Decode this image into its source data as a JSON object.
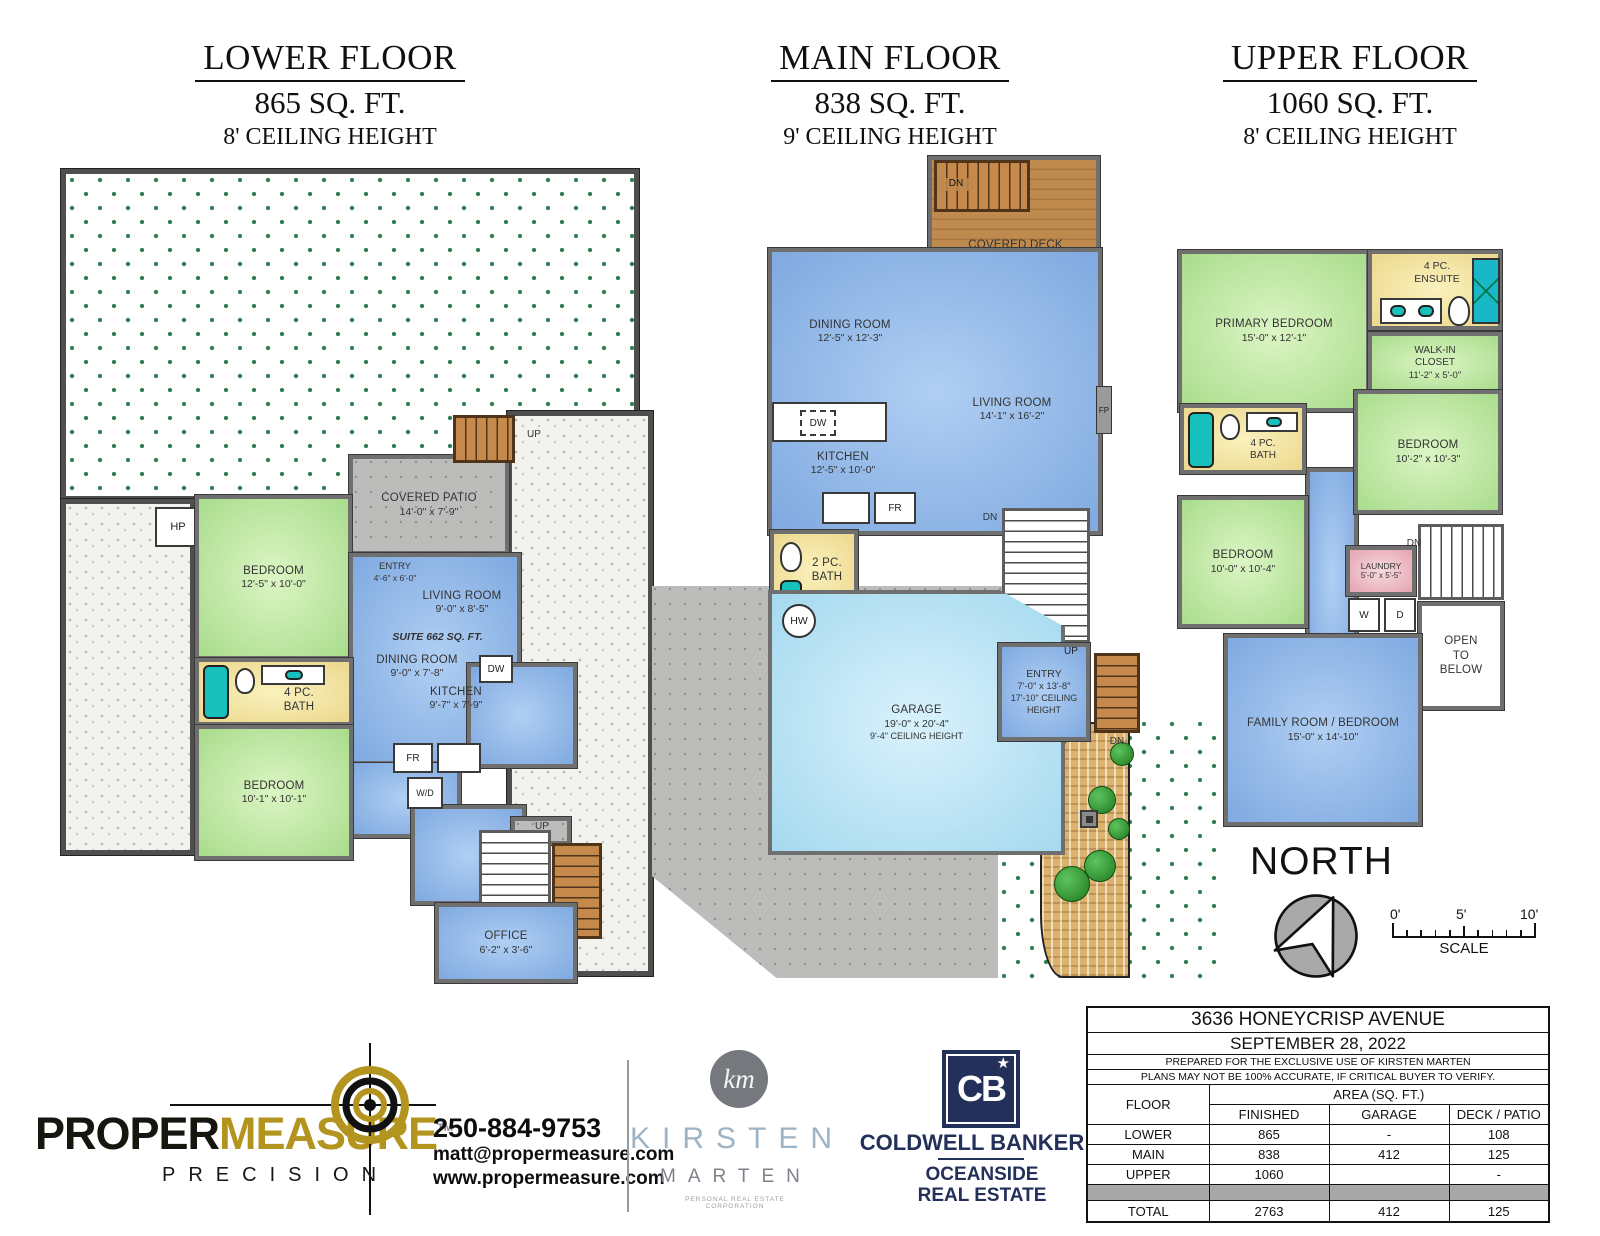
{
  "titles": {
    "lower": {
      "floor": "LOWER FLOOR",
      "area": "865 SQ. FT.",
      "ceiling": "8' CEILING HEIGHT"
    },
    "main": {
      "floor": "MAIN FLOOR",
      "area": "838 SQ. FT.",
      "ceiling": "9' CEILING HEIGHT"
    },
    "upper": {
      "floor": "UPPER FLOOR",
      "area": "1060 SQ. FT.",
      "ceiling": "8' CEILING HEIGHT"
    }
  },
  "lower": {
    "hp": "HP",
    "bedroom1": {
      "name": "BEDROOM",
      "dims": "12'-5\" x 10'-0\""
    },
    "patio": {
      "name": "COVERED PATIO",
      "dims": "14'-0\" x 7'-9\""
    },
    "up_top": "UP",
    "entry": {
      "name": "ENTRY",
      "dims": "4'-6\" x 6'-0\""
    },
    "living": {
      "name": "LIVING ROOM",
      "dims": "9'-0\" x 8'-5\""
    },
    "suite": "SUITE 662 SQ. FT.",
    "dining": {
      "name": "DINING ROOM",
      "dims": "9'-0\" x 7'-8\""
    },
    "kitchen": {
      "name": "KITCHEN",
      "dims": "9'-7\" x 7'-9\""
    },
    "dw": "DW",
    "fr": "FR",
    "wd": "W/D",
    "bath": {
      "name": "4 PC.",
      "name2": "BATH"
    },
    "bedroom2": {
      "name": "BEDROOM",
      "dims": "10'-1\" x 10'-1\""
    },
    "up_mid": "UP",
    "up_stairs": "UP",
    "office": {
      "name": "OFFICE",
      "dims": "6'-2\" x 3'-6\""
    }
  },
  "main": {
    "deck": {
      "name": "COVERED DECK",
      "dims": "14'-1\" x 7'-10\""
    },
    "dn_deck": "DN",
    "dining": {
      "name": "DINING ROOM",
      "dims": "12'-5\" x 12'-3\""
    },
    "living": {
      "name": "LIVING ROOM",
      "dims": "14'-1\" x 16'-2\""
    },
    "fp": "FP",
    "dw": "DW",
    "kitchen": {
      "name": "KITCHEN",
      "dims": "12'-5\" x 10'-0\""
    },
    "fr": "FR",
    "bath": {
      "name": "2 PC.",
      "name2": "BATH"
    },
    "hw": "HW",
    "dn_stairs": "DN",
    "entry": {
      "name": "ENTRY",
      "dims": "7'-0\" x 13'-8\"",
      "ceiling": "17'-10\" CEILING HEIGHT"
    },
    "up": "UP",
    "dn_out": "DN",
    "garage": {
      "name": "GARAGE",
      "dims": "19'-0\" x 20'-4\"",
      "ceiling": "9'-4\" CEILING HEIGHT"
    }
  },
  "upper": {
    "primary": {
      "name": "PRIMARY BEDROOM",
      "dims": "15'-0\" x 12'-1\""
    },
    "ensuite": {
      "name": "4 PC.",
      "name2": "ENSUITE"
    },
    "wic": {
      "name": "WALK-IN",
      "name2": "CLOSET",
      "dims": "11'-2\" x 5'-0\""
    },
    "bath": {
      "name": "4 PC.",
      "name2": "BATH"
    },
    "bedroom1": {
      "name": "BEDROOM",
      "dims": "10'-2\" x 10'-3\""
    },
    "bedroom2": {
      "name": "BEDROOM",
      "dims": "10'-0\" x 10'-4\""
    },
    "laundry": {
      "name": "LAUNDRY",
      "dims": "5'-0\" x 5'-5\""
    },
    "w": "W",
    "d": "D",
    "dn": "DN",
    "open": {
      "l1": "OPEN",
      "l2": "TO",
      "l3": "BELOW"
    },
    "family": {
      "name": "FAMILY ROOM / BEDROOM",
      "dims": "15'-0\" x 14'-10\""
    }
  },
  "compass": {
    "north": "NORTH"
  },
  "scalebar": {
    "t0": "0'",
    "t5": "5'",
    "t10": "10'",
    "label": "SCALE"
  },
  "footer": {
    "pm": {
      "word1": "PROPER",
      "word2": "MEASURE",
      "tm": "TM",
      "tagline": "PRECISION",
      "phone": "250-884-9753",
      "email": "matt@propermeasure.com",
      "web": "www.propermeasure.com"
    },
    "km": {
      "monogram": "km",
      "first": "KIRSTEN",
      "last": "MARTEN",
      "sub": "PERSONAL REAL ESTATE CORPORATION"
    },
    "cb": {
      "monogram": "CB",
      "star": "★",
      "name": "COLDWELL BANKER",
      "sub1": "OCEANSIDE",
      "sub2": "REAL ESTATE"
    }
  },
  "table": {
    "address": "3636 HONEYCRISP AVENUE",
    "date": "SEPTEMBER 28, 2022",
    "note1": "PREPARED FOR THE EXCLUSIVE USE OF KIRSTEN MARTEN",
    "note2": "PLANS MAY NOT BE 100% ACCURATE, IF CRITICAL BUYER TO VERIFY.",
    "floor_h": "FLOOR",
    "area_h": "AREA (SQ. FT.)",
    "finished_h": "FINISHED",
    "garage_h": "GARAGE",
    "deck_h": "DECK / PATIO",
    "rows": [
      {
        "floor": "LOWER",
        "finished": "865",
        "garage": "-",
        "deck": "108"
      },
      {
        "floor": "MAIN",
        "finished": "838",
        "garage": "412",
        "deck": "125"
      },
      {
        "floor": "UPPER",
        "finished": "1060",
        "garage": "",
        "deck": "-"
      }
    ],
    "total": {
      "floor": "TOTAL",
      "finished": "2763",
      "garage": "412",
      "deck": "125"
    }
  }
}
